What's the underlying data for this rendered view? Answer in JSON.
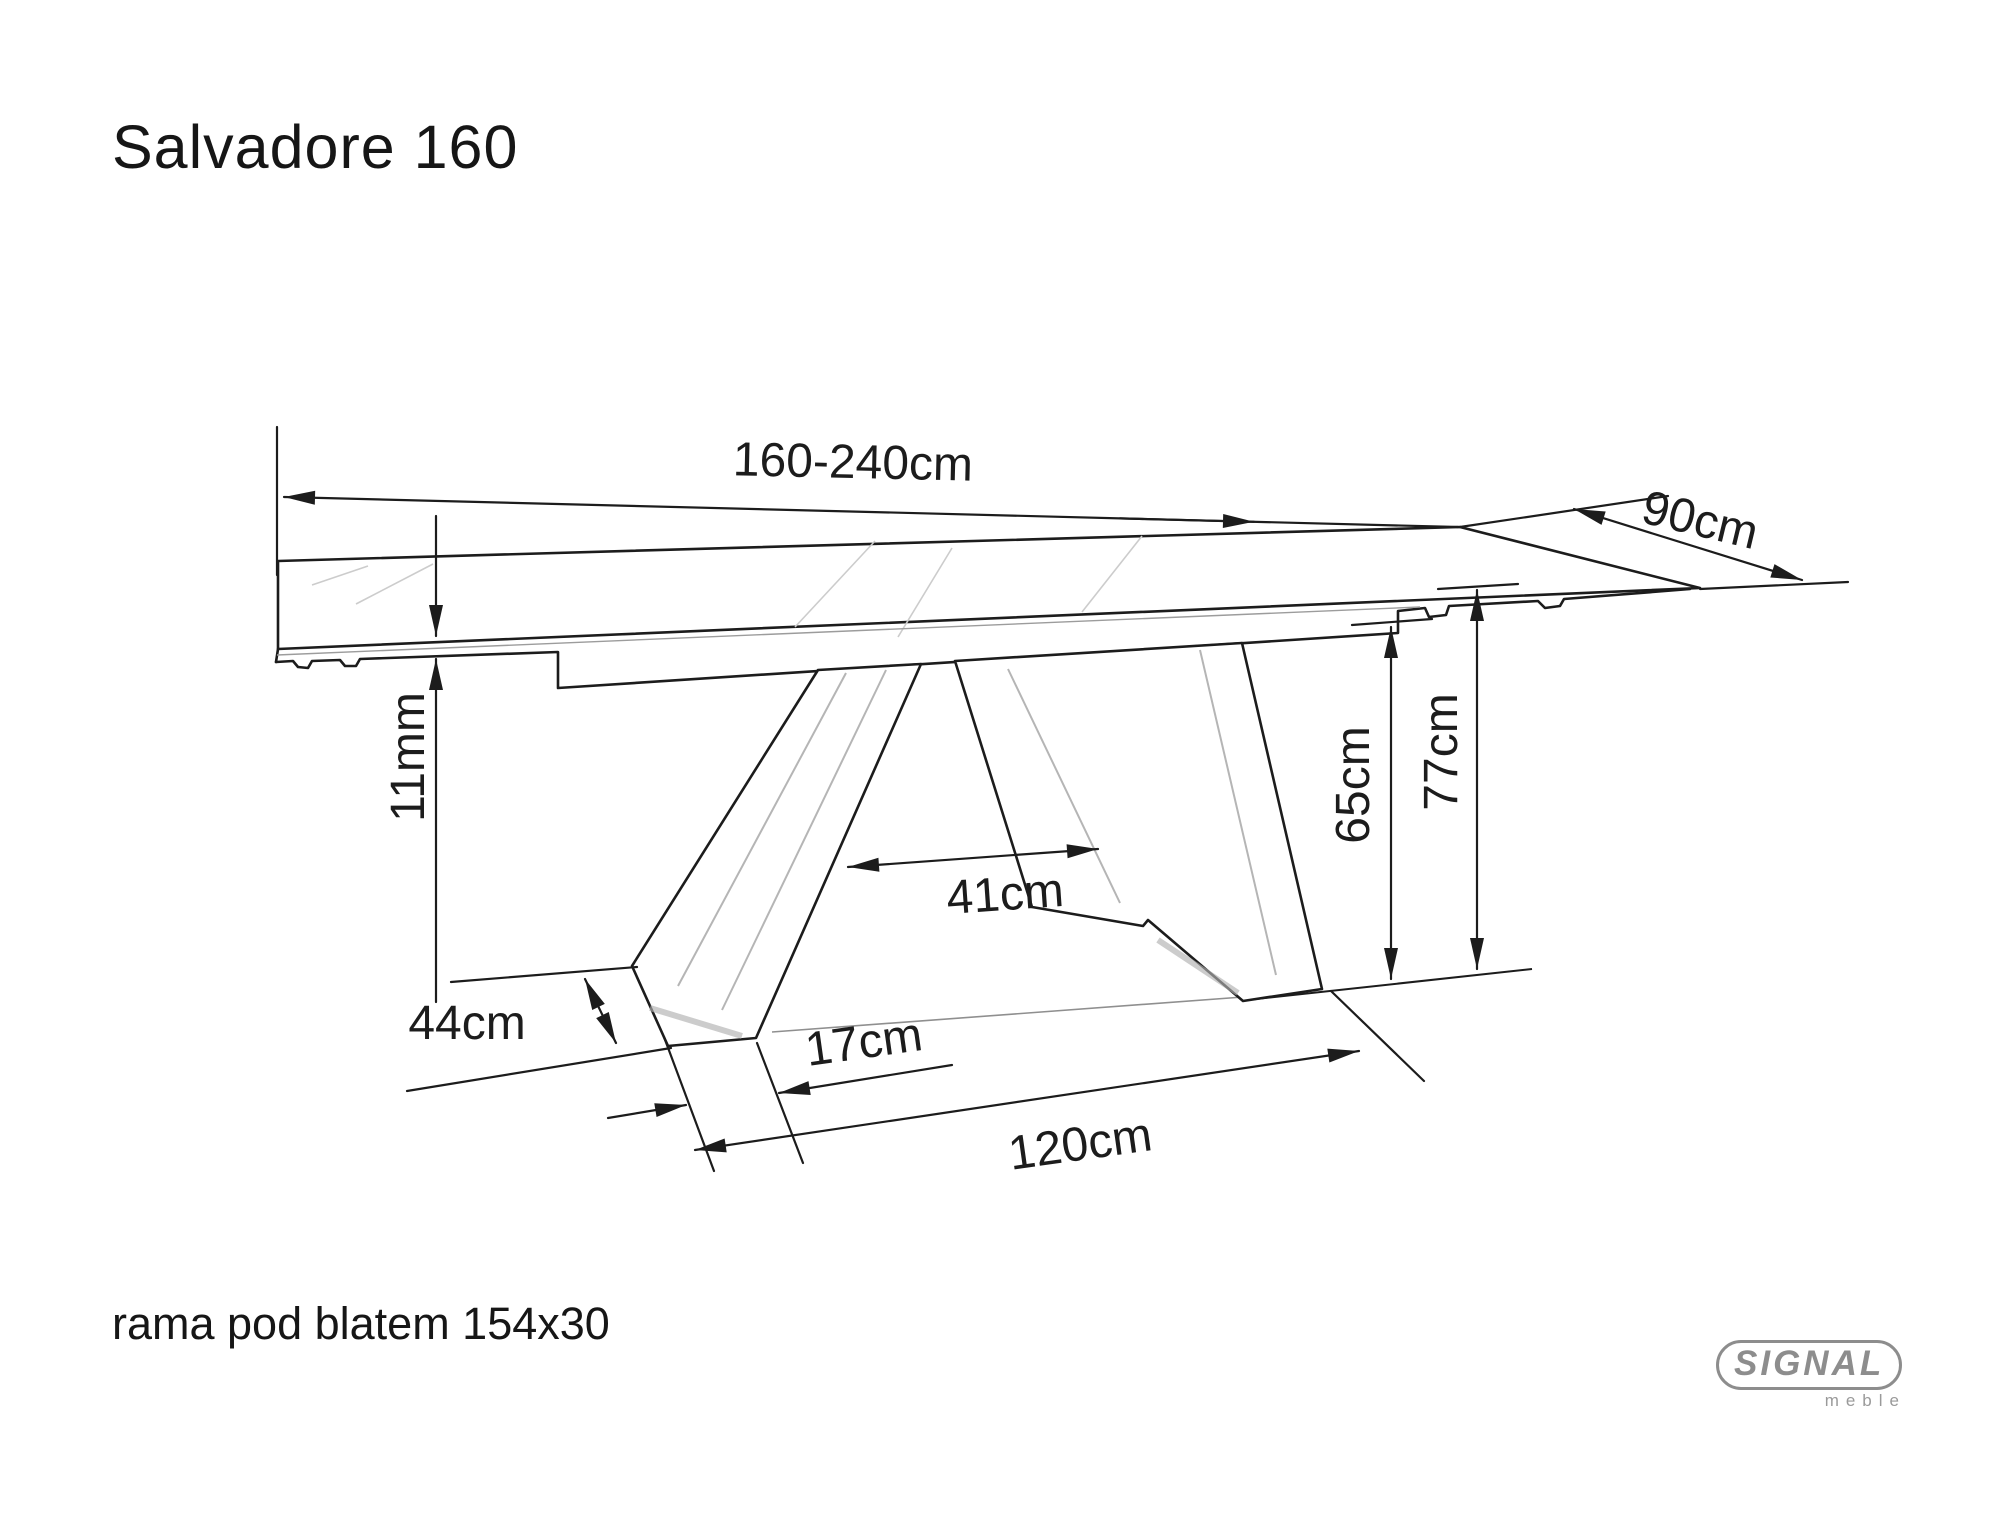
{
  "page": {
    "background": "#ffffff"
  },
  "header": {
    "title": "Salvadore 160"
  },
  "diagram": {
    "type": "furniture-dimension-drawing",
    "subject": "extendable dining table",
    "stroke_color": "#1c1c1c",
    "dimensions": {
      "length": "160-240cm",
      "depth": "90cm",
      "top_thickness": "11mm",
      "leg_inner_span": "41cm",
      "underframe_height": "65cm",
      "total_height": "77cm",
      "foot_depth": "44cm",
      "foot_width": "17cm",
      "base_length": "120cm"
    }
  },
  "footer": {
    "note": "rama pod blatem 154x30",
    "logo": {
      "brand": "SIGNAL",
      "subbrand": "meble",
      "color": "#8d8d8d"
    }
  }
}
